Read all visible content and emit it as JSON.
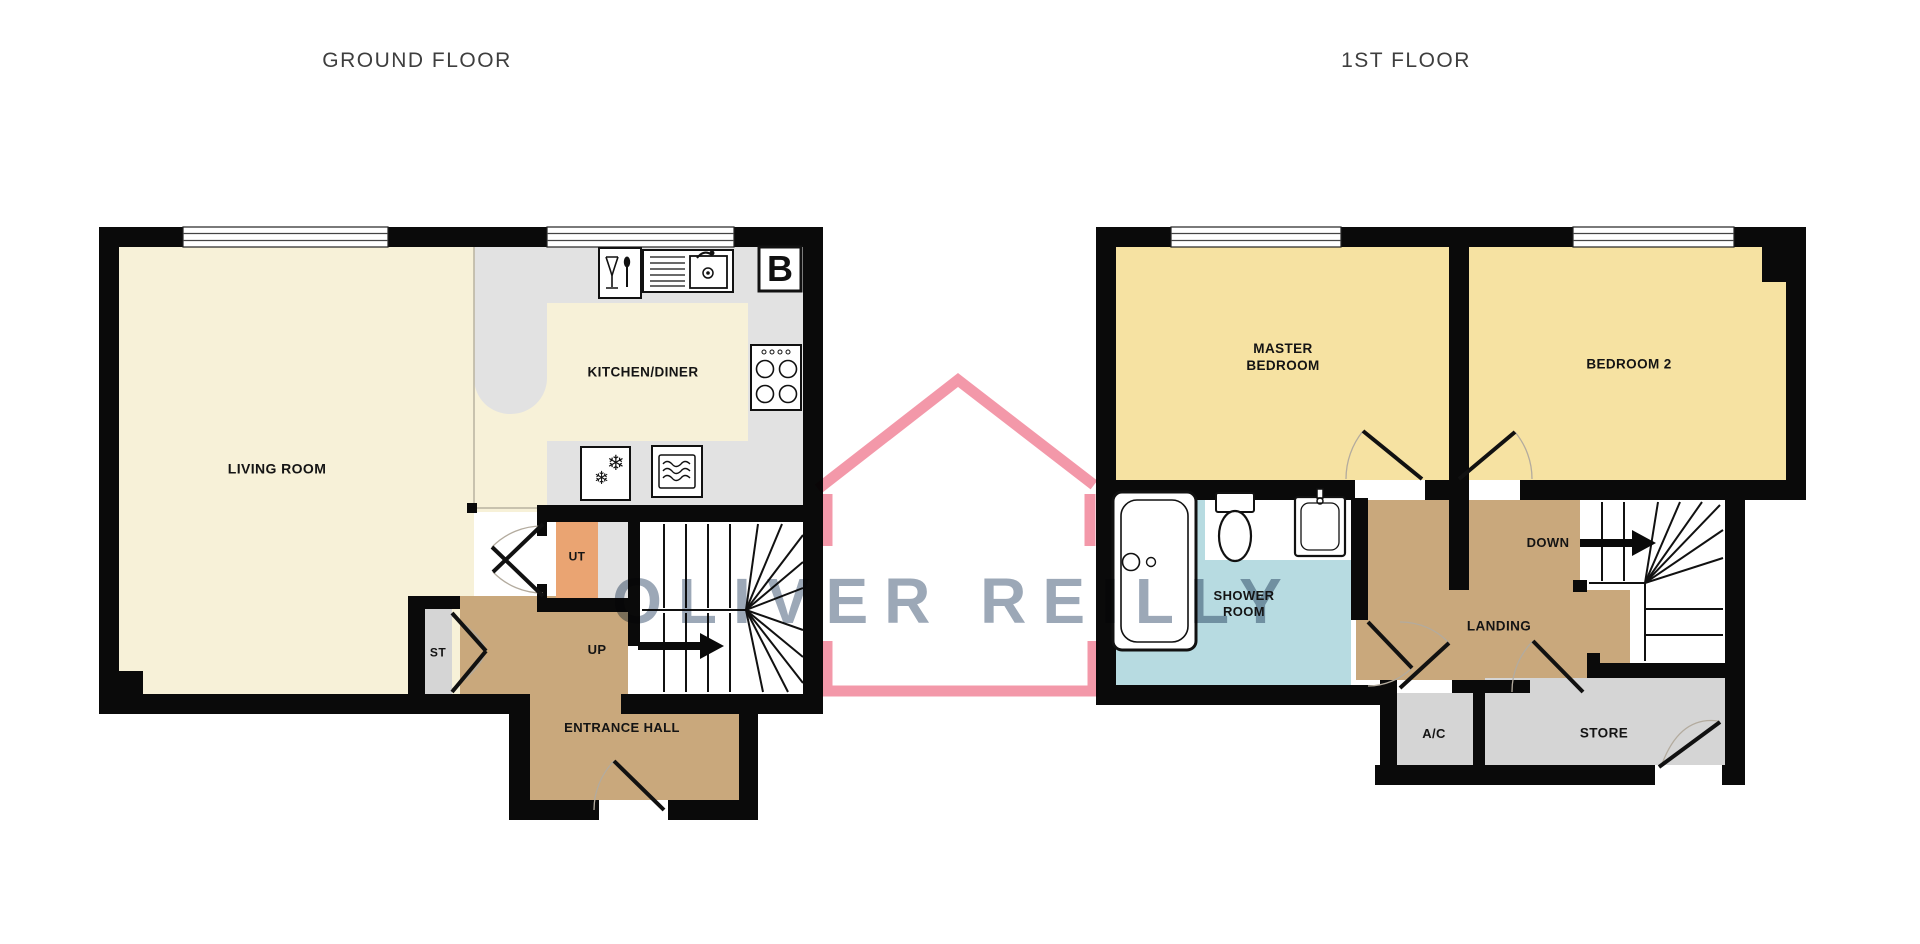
{
  "titles": {
    "ground": "GROUND FLOOR",
    "first": "1ST FLOOR"
  },
  "watermark": {
    "brand": "OLIVER REILLY",
    "house_color": "#f28da0",
    "text_color": "#8695a7"
  },
  "ground_floor": {
    "rooms": {
      "living": "LIVING ROOM",
      "kitchen": "KITCHEN/DINER",
      "utility": "UT",
      "storage": "ST",
      "hall": "ENTRANCE HALL"
    },
    "stairs_direction": "UP",
    "boiler": "B"
  },
  "first_floor": {
    "rooms": {
      "master": "MASTER BEDROOM",
      "bedroom2": "BEDROOM 2",
      "shower": "SHOWER ROOM",
      "landing": "LANDING",
      "airing_cupboard": "A/C",
      "store": "STORE"
    },
    "stairs_direction": "DOWN"
  },
  "icons": {
    "snowflake": "❄"
  },
  "colors": {
    "wall": "#0a0a0a",
    "living_cream": "#f7f1d8",
    "bedroom_yellow": "#f6e2a2",
    "counter_gray": "#e2e2e2",
    "closet_gray": "#d5d5d5",
    "hall_tan": "#c9a87c",
    "utility_orange": "#eaa472",
    "shower_blue": "#b7dbe1"
  }
}
